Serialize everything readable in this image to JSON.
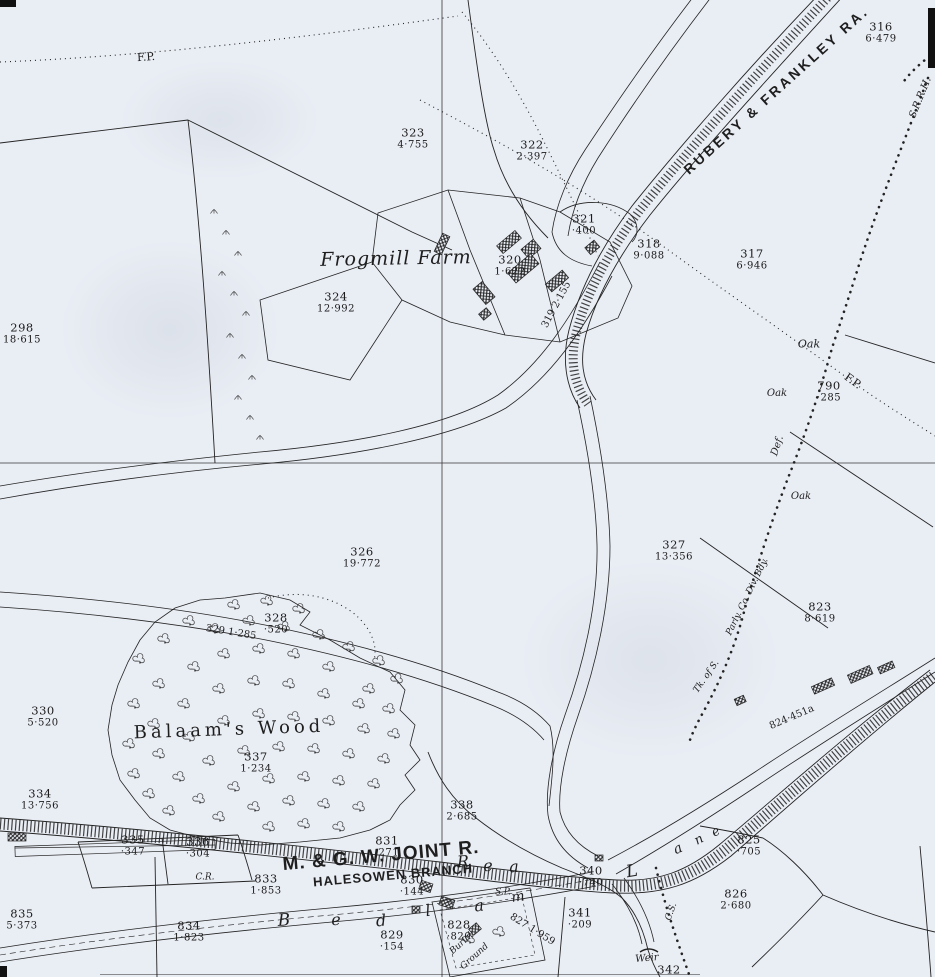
{
  "map": {
    "kind": "Ordnance Survey style 25-inch sheet extract",
    "paper_color": "#e9edf4",
    "ink_color": "#1e1e1e",
    "railway_top": "RUBERY & FRANKLEY RA.",
    "railway_bottom": "M. & G. W. JOINT R.",
    "railway_bottom_branch": "HALESOWEN BRANCH",
    "farm_name": "Frogmill Farm",
    "wood_name": "Balaam's Wood",
    "river_name_letters": "R e a",
    "lane_letters": "L a n e",
    "bed_letters": "B e d l a m"
  },
  "parcels": [
    {
      "n": "316",
      "a": "6·479",
      "x": 881,
      "y": 33
    },
    {
      "n": "323",
      "a": "4·755",
      "x": 413,
      "y": 139
    },
    {
      "n": "322",
      "a": "2·397",
      "x": 532,
      "y": 151
    },
    {
      "n": "321",
      "a": "·400",
      "x": 584,
      "y": 225
    },
    {
      "n": "320",
      "a": "1·622",
      "x": 510,
      "y": 266
    },
    {
      "n": "318",
      "a": "9·088",
      "x": 649,
      "y": 250
    },
    {
      "n": "317",
      "a": "6·946",
      "x": 752,
      "y": 260
    },
    {
      "n": "324",
      "a": "12·992",
      "x": 336,
      "y": 303
    },
    {
      "n": "298",
      "a": "18·615",
      "x": 22,
      "y": 334
    },
    {
      "n": "790",
      "a": "·285",
      "x": 829,
      "y": 392
    },
    {
      "n": "326",
      "a": "19·772",
      "x": 362,
      "y": 558
    },
    {
      "n": "327",
      "a": "13·356",
      "x": 674,
      "y": 551
    },
    {
      "n": "823",
      "a": "8·619",
      "x": 820,
      "y": 613
    },
    {
      "n": "328",
      "a": "·520",
      "x": 276,
      "y": 624
    },
    {
      "n": "330",
      "a": "5·520",
      "x": 43,
      "y": 717
    },
    {
      "n": "337",
      "a": "1·234",
      "x": 256,
      "y": 763
    },
    {
      "n": "334",
      "a": "13·756",
      "x": 40,
      "y": 800
    },
    {
      "n": "338",
      "a": "2·685",
      "x": 462,
      "y": 811
    },
    {
      "n": "335",
      "a": "·347",
      "x": 133,
      "y": 846
    },
    {
      "n": "336",
      "a": "·304",
      "x": 198,
      "y": 848
    },
    {
      "n": "833",
      "a": "1·853",
      "x": 266,
      "y": 885
    },
    {
      "n": "831",
      "a": "·271",
      "x": 387,
      "y": 847
    },
    {
      "n": "830",
      "a": "·144",
      "x": 412,
      "y": 886
    },
    {
      "n": "340",
      "a": "·740",
      "x": 591,
      "y": 877
    },
    {
      "n": "825",
      "a": "·705",
      "x": 749,
      "y": 846
    },
    {
      "n": "826",
      "a": "2·680",
      "x": 736,
      "y": 900
    },
    {
      "n": "341",
      "a": "·209",
      "x": 580,
      "y": 919
    },
    {
      "n": "828",
      "a": "·820",
      "x": 459,
      "y": 931
    },
    {
      "n": "829",
      "a": "·154",
      "x": 392,
      "y": 941
    },
    {
      "n": "835",
      "a": "5·373",
      "x": 22,
      "y": 920
    },
    {
      "n": "834",
      "a": "1·823",
      "x": 189,
      "y": 932
    },
    {
      "n": "342",
      "a": "",
      "x": 669,
      "y": 970
    }
  ],
  "labels": [
    {
      "t": "F.P.",
      "x": 146,
      "y": 57,
      "r": -4,
      "s": 11,
      "f": "rm"
    },
    {
      "t": "RUBERY & FRANKLEY RA.",
      "x": 776,
      "y": 90,
      "r": -42,
      "s": 14,
      "f": "sans",
      "ls": 3
    },
    {
      "t": "S.R.R.H.",
      "x": 921,
      "y": 98,
      "r": -68,
      "s": 10,
      "f": "it"
    },
    {
      "t": "Frogmill Farm",
      "x": 396,
      "y": 259,
      "r": -1,
      "s": 19,
      "f": "it",
      "ls": 1
    },
    {
      "t": "319 2·155",
      "x": 557,
      "y": 305,
      "r": -62,
      "s": 10,
      "f": "rm"
    },
    {
      "t": "Oak",
      "x": 809,
      "y": 344,
      "r": 0,
      "s": 11,
      "f": "it"
    },
    {
      "t": "F.P.",
      "x": 853,
      "y": 381,
      "r": 36,
      "s": 11,
      "f": "rm"
    },
    {
      "t": "Oak",
      "x": 777,
      "y": 394,
      "r": 0,
      "s": 10,
      "f": "it"
    },
    {
      "t": "Def.",
      "x": 778,
      "y": 446,
      "r": -72,
      "s": 10,
      "f": "it"
    },
    {
      "t": "Oak",
      "x": 801,
      "y": 497,
      "r": 0,
      "s": 10,
      "f": "it"
    },
    {
      "t": "Parly. Co. Div. Bdy.",
      "x": 748,
      "y": 597,
      "r": -64,
      "s": 9,
      "f": "it"
    },
    {
      "t": "Tk. of S.",
      "x": 707,
      "y": 677,
      "r": -55,
      "s": 9,
      "f": "it"
    },
    {
      "t": "329 1·285",
      "x": 231,
      "y": 633,
      "r": 9,
      "s": 10,
      "f": "rm"
    },
    {
      "t": "Balaam's Wood",
      "x": 229,
      "y": 730,
      "r": -2,
      "s": 18,
      "f": "rm",
      "ls": 4
    },
    {
      "t": "824·451a",
      "x": 792,
      "y": 718,
      "r": -23,
      "s": 10,
      "f": "rm"
    },
    {
      "t": "M. & G. W. JOINT R.",
      "x": 381,
      "y": 856,
      "r": -5,
      "s": 19,
      "f": "sans",
      "ls": 1
    },
    {
      "t": "HALESOWEN BRANCH",
      "x": 393,
      "y": 875,
      "r": -5,
      "s": 13,
      "f": "sans",
      "ls": 1
    },
    {
      "t": "C.R.",
      "x": 205,
      "y": 878,
      "r": 0,
      "s": 9,
      "f": "it"
    },
    {
      "t": "S.P.",
      "x": 503,
      "y": 893,
      "r": 0,
      "s": 9,
      "f": "it"
    },
    {
      "t": "827 1·959",
      "x": 532,
      "y": 930,
      "r": 32,
      "s": 10,
      "f": "rm"
    },
    {
      "t": "Burial",
      "x": 462,
      "y": 944,
      "r": -42,
      "s": 9,
      "f": "it"
    },
    {
      "t": "Ground",
      "x": 475,
      "y": 957,
      "r": -42,
      "s": 9,
      "f": "it"
    },
    {
      "t": "Weir",
      "x": 647,
      "y": 959,
      "r": -5,
      "s": 10,
      "f": "it"
    },
    {
      "t": "C.S.",
      "x": 672,
      "y": 912,
      "r": -70,
      "s": 9,
      "f": "it"
    },
    {
      "t": "R",
      "x": 463,
      "y": 862,
      "r": -3,
      "s": 16,
      "f": "it"
    },
    {
      "t": "e",
      "x": 488,
      "y": 866,
      "r": -3,
      "s": 16,
      "f": "it"
    },
    {
      "t": "a",
      "x": 514,
      "y": 867,
      "r": -3,
      "s": 16,
      "f": "it"
    },
    {
      "t": "B",
      "x": 284,
      "y": 921,
      "r": -3,
      "s": 17,
      "f": "it"
    },
    {
      "t": "e",
      "x": 336,
      "y": 920,
      "r": -3,
      "s": 16,
      "f": "it"
    },
    {
      "t": "d",
      "x": 381,
      "y": 921,
      "r": -5,
      "s": 16,
      "f": "it"
    },
    {
      "t": "l",
      "x": 428,
      "y": 911,
      "r": -8,
      "s": 16,
      "f": "it"
    },
    {
      "t": "a",
      "x": 479,
      "y": 906,
      "r": -8,
      "s": 16,
      "f": "it"
    },
    {
      "t": "m",
      "x": 518,
      "y": 897,
      "r": -8,
      "s": 14,
      "f": "it"
    },
    {
      "t": "L",
      "x": 632,
      "y": 872,
      "r": -10,
      "s": 17,
      "f": "it"
    },
    {
      "t": "a",
      "x": 678,
      "y": 849,
      "r": -25,
      "s": 14,
      "f": "it"
    },
    {
      "t": "n",
      "x": 699,
      "y": 840,
      "r": -28,
      "s": 13,
      "f": "it"
    },
    {
      "t": "e",
      "x": 716,
      "y": 832,
      "r": -30,
      "s": 13,
      "f": "it"
    }
  ]
}
